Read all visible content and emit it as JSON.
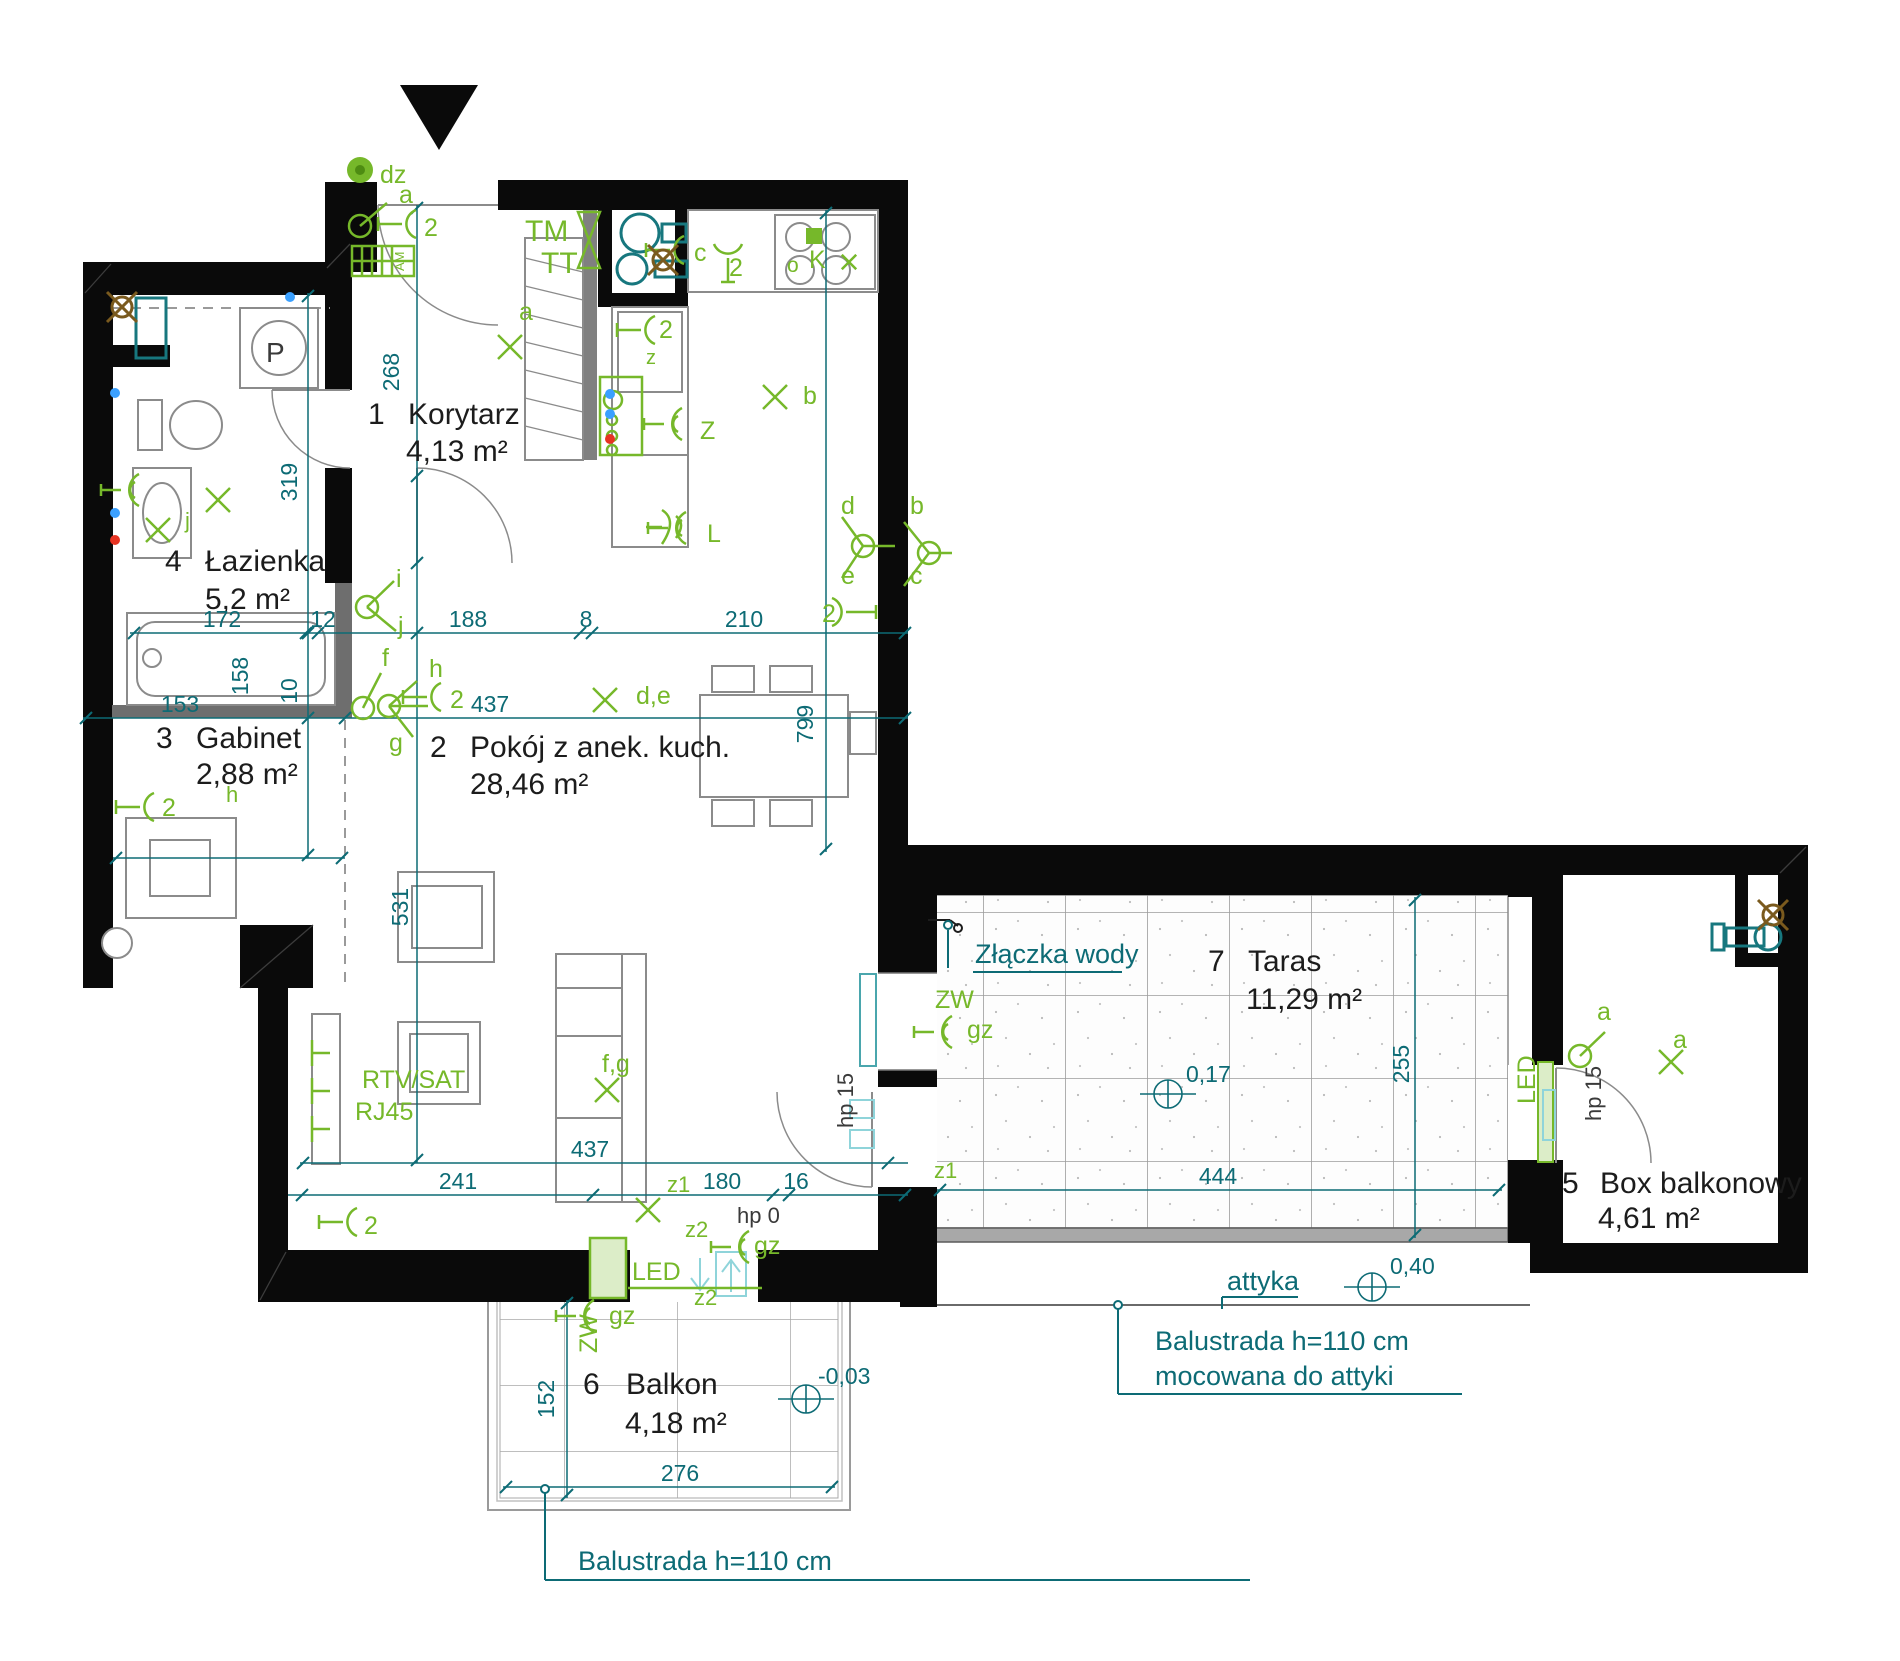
{
  "plan": {
    "width": 1900,
    "height": 1661,
    "background": "#ffffff"
  },
  "colors": {
    "wall": "#0a0a0a",
    "interior_wall": "#6e6e6e",
    "furniture": "#8b8b8b",
    "dim": "#0d6b75",
    "light_cyan": "#8fd4da",
    "el": "#76b82a",
    "fixture": "#17777e",
    "brown": "#7a5a1e",
    "text": "#1c1c1c",
    "gray_label": "#3a3a3a",
    "dot_blue": "#3aa0ff",
    "dot_red": "#e63322",
    "led_fill": "#dcedc8"
  },
  "rooms": [
    {
      "number": "1",
      "name": "Korytarz",
      "area": "4,13 m²",
      "nx": 368,
      "ny": 424,
      "tx": 408,
      "ty": 424,
      "ax": 406,
      "ay": 461
    },
    {
      "number": "2",
      "name": "Pokój z anek. kuch.",
      "area": "28,46 m²",
      "nx": 430,
      "ny": 757,
      "tx": 470,
      "ty": 757,
      "ax": 470,
      "ay": 794
    },
    {
      "number": "3",
      "name": "Gabinet",
      "area": "2,88 m²",
      "nx": 156,
      "ny": 748,
      "tx": 196,
      "ty": 748,
      "ax": 196,
      "ay": 784
    },
    {
      "number": "4",
      "name": "Łazienka",
      "area": "5,2 m²",
      "nx": 165,
      "ny": 571,
      "tx": 205,
      "ty": 571,
      "ax": 205,
      "ay": 609
    },
    {
      "number": "5",
      "name": "Box balkonowy",
      "area": "4,61 m²",
      "nx": 1562,
      "ny": 1193,
      "tx": 1600,
      "ty": 1193,
      "ax": 1598,
      "ay": 1228
    },
    {
      "number": "6",
      "name": "Balkon",
      "area": "4,18 m²",
      "nx": 583,
      "ny": 1394,
      "tx": 626,
      "ty": 1394,
      "ax": 625,
      "ay": 1433
    },
    {
      "number": "7",
      "name": "Taras",
      "area": "11,29 m²",
      "nx": 1208,
      "ny": 971,
      "tx": 1248,
      "ty": 971,
      "ax": 1246,
      "ay": 1009
    }
  ],
  "dimensions": [
    {
      "t": "172",
      "x": 222,
      "y": 627
    },
    {
      "t": "12",
      "x": 323,
      "y": 627
    },
    {
      "t": "188",
      "x": 468,
      "y": 627
    },
    {
      "t": "8",
      "x": 586,
      "y": 627
    },
    {
      "t": "210",
      "x": 744,
      "y": 627
    },
    {
      "t": "153",
      "x": 180,
      "y": 712
    },
    {
      "t": "437",
      "x": 490,
      "y": 712
    },
    {
      "t": "437",
      "x": 590,
      "y": 1157
    },
    {
      "t": "241",
      "x": 458,
      "y": 1189
    },
    {
      "t": "180",
      "x": 722,
      "y": 1189
    },
    {
      "t": "16",
      "x": 796,
      "y": 1189
    },
    {
      "t": "444",
      "x": 1218,
      "y": 1184
    },
    {
      "t": "276",
      "x": 680,
      "y": 1481
    },
    {
      "t": "268",
      "x": 399,
      "y": 372,
      "r": -90
    },
    {
      "t": "319",
      "x": 297,
      "y": 482,
      "r": -90
    },
    {
      "t": "158",
      "x": 248,
      "y": 676,
      "r": -90
    },
    {
      "t": "10",
      "x": 297,
      "y": 691,
      "r": -90
    },
    {
      "t": "531",
      "x": 408,
      "y": 907,
      "r": -90
    },
    {
      "t": "799",
      "x": 813,
      "y": 724,
      "r": -90
    },
    {
      "t": "255",
      "x": 1409,
      "y": 1064,
      "r": -90
    },
    {
      "t": "152",
      "x": 554,
      "y": 1399,
      "r": -90
    }
  ],
  "notes": [
    {
      "t": "Złączka wody",
      "x": 975,
      "y": 963
    },
    {
      "t": "attyka",
      "x": 1227,
      "y": 1290
    },
    {
      "t": "Balustrada h=110 cm",
      "x": 578,
      "y": 1570
    },
    {
      "t": "Balustrada h=110 cm",
      "x": 1155,
      "y": 1350
    },
    {
      "t": "mocowana do attyki",
      "x": 1155,
      "y": 1385
    }
  ],
  "elevations": [
    {
      "t": "0,17",
      "x": 1186,
      "y": 1082,
      "cx": 1168,
      "cy": 1094
    },
    {
      "t": "0,40",
      "x": 1390,
      "y": 1274,
      "cx": 1372,
      "cy": 1287
    },
    {
      "t": "-0,03",
      "x": 818,
      "y": 1384,
      "cx": 806,
      "cy": 1399
    }
  ],
  "gray_labels": [
    {
      "t": "hp 0",
      "x": 737,
      "y": 1223
    },
    {
      "t": "hp 15",
      "x": 853,
      "y": 1128,
      "r": -90
    },
    {
      "t": "hp 15",
      "x": 1601,
      "y": 1121,
      "r": -90
    },
    {
      "t": "P",
      "x": 266,
      "y": 362,
      "s": 28
    }
  ],
  "green_labels": [
    {
      "t": "dz",
      "x": 380,
      "y": 183
    },
    {
      "t": "a",
      "x": 399,
      "y": 203
    },
    {
      "t": "2",
      "x": 424,
      "y": 236
    },
    {
      "t": "a",
      "x": 519,
      "y": 320
    },
    {
      "t": "TM",
      "x": 525,
      "y": 241,
      "s": 30
    },
    {
      "t": "TT",
      "x": 541,
      "y": 273,
      "s": 30
    },
    {
      "t": "c",
      "x": 694,
      "y": 261
    },
    {
      "t": "2",
      "x": 729,
      "y": 276
    },
    {
      "t": "o",
      "x": 787,
      "y": 272,
      "s": 21
    },
    {
      "t": "K",
      "x": 809,
      "y": 268
    },
    {
      "t": "2",
      "x": 659,
      "y": 338
    },
    {
      "t": "z",
      "x": 646,
      "y": 364,
      "s": 20
    },
    {
      "t": "Z",
      "x": 700,
      "y": 439
    },
    {
      "t": "L",
      "x": 707,
      "y": 542
    },
    {
      "t": "b",
      "x": 803,
      "y": 404
    },
    {
      "t": "d",
      "x": 841,
      "y": 514
    },
    {
      "t": "b",
      "x": 910,
      "y": 514
    },
    {
      "t": "e",
      "x": 841,
      "y": 584
    },
    {
      "t": "c",
      "x": 910,
      "y": 584
    },
    {
      "t": "2",
      "x": 822,
      "y": 622
    },
    {
      "t": "d,e",
      "x": 636,
      "y": 704
    },
    {
      "t": "i",
      "x": 396,
      "y": 587
    },
    {
      "t": "j",
      "x": 398,
      "y": 634
    },
    {
      "t": "f",
      "x": 382,
      "y": 666
    },
    {
      "t": "h",
      "x": 429,
      "y": 677
    },
    {
      "t": "2",
      "x": 450,
      "y": 708
    },
    {
      "t": "g",
      "x": 389,
      "y": 751
    },
    {
      "t": "j",
      "x": 185,
      "y": 528,
      "s": 22
    },
    {
      "t": "h",
      "x": 226,
      "y": 802,
      "s": 22
    },
    {
      "t": "2",
      "x": 162,
      "y": 816
    },
    {
      "t": "RTV/SAT",
      "x": 362,
      "y": 1088
    },
    {
      "t": "RJ45",
      "x": 355,
      "y": 1120
    },
    {
      "t": "2",
      "x": 364,
      "y": 1234
    },
    {
      "t": "f,g",
      "x": 602,
      "y": 1072
    },
    {
      "t": "z1",
      "x": 667,
      "y": 1192,
      "s": 22
    },
    {
      "t": "z2",
      "x": 685,
      "y": 1237,
      "s": 22
    },
    {
      "t": "z2",
      "x": 694,
      "y": 1305,
      "s": 22
    },
    {
      "t": "gz",
      "x": 754,
      "y": 1254
    },
    {
      "t": "LED",
      "x": 632,
      "y": 1280
    },
    {
      "t": "gz",
      "x": 609,
      "y": 1324
    },
    {
      "t": "ZW",
      "x": 597,
      "y": 1353,
      "r": -90
    },
    {
      "t": "ZW",
      "x": 935,
      "y": 1008
    },
    {
      "t": "gz",
      "x": 967,
      "y": 1038
    },
    {
      "t": "z1",
      "x": 934,
      "y": 1178,
      "s": 22
    },
    {
      "t": "LED",
      "x": 1535,
      "y": 1104,
      "r": -90
    },
    {
      "t": "a",
      "x": 1597,
      "y": 1020
    },
    {
      "t": "a",
      "x": 1673,
      "y": 1048
    },
    {
      "t": "AM",
      "x": 404,
      "y": 271,
      "s": 13,
      "r": -90
    }
  ],
  "lines": [
    {
      "x1": 130,
      "y1": 633,
      "x2": 908,
      "y2": 633
    },
    {
      "x1": 83,
      "y1": 718,
      "x2": 908,
      "y2": 718
    },
    {
      "x1": 113,
      "y1": 858,
      "x2": 345,
      "y2": 858
    },
    {
      "x1": 300,
      "y1": 1163,
      "x2": 908,
      "y2": 1163
    },
    {
      "x1": 288,
      "y1": 1195,
      "x2": 908,
      "y2": 1195
    },
    {
      "x1": 937,
      "y1": 1190,
      "x2": 1502,
      "y2": 1190
    },
    {
      "x1": 503,
      "y1": 1487,
      "x2": 835,
      "y2": 1487
    },
    {
      "x1": 417,
      "y1": 205,
      "x2": 417,
      "y2": 1163
    },
    {
      "x1": 308,
      "y1": 293,
      "x2": 308,
      "y2": 858
    },
    {
      "x1": 826,
      "y1": 210,
      "x2": 826,
      "y2": 852
    },
    {
      "x1": 1415,
      "y1": 897,
      "x2": 1415,
      "y2": 1238
    },
    {
      "x1": 567,
      "y1": 1300,
      "x2": 567,
      "y2": 1498
    },
    {
      "x1": 973,
      "y1": 972,
      "x2": 1122,
      "y2": 972,
      "w": 2
    },
    {
      "x1": 948,
      "y1": 930,
      "x2": 948,
      "y2": 968,
      "w": 2
    },
    {
      "x1": 1222,
      "y1": 1297,
      "x2": 1298,
      "y2": 1297,
      "w": 2
    },
    {
      "x1": 1222,
      "y1": 1297,
      "x2": 1222,
      "y2": 1309,
      "w": 2
    },
    {
      "x1": 545,
      "y1": 1492,
      "x2": 545,
      "y2": 1580,
      "w": 2
    },
    {
      "x1": 545,
      "y1": 1580,
      "x2": 1250,
      "y2": 1580,
      "w": 2
    },
    {
      "x1": 1118,
      "y1": 1308,
      "x2": 1118,
      "y2": 1394,
      "w": 2
    },
    {
      "x1": 1118,
      "y1": 1394,
      "x2": 1462,
      "y2": 1394,
      "w": 2
    },
    {
      "x1": 628,
      "y1": 1288,
      "x2": 762,
      "y2": 1288,
      "c": "el",
      "w": 2.5
    }
  ],
  "ticks": [
    [
      134,
      633
    ],
    [
      306,
      633
    ],
    [
      318,
      633
    ],
    [
      580,
      633
    ],
    [
      592,
      633
    ],
    [
      905,
      633
    ],
    [
      86,
      718
    ],
    [
      345,
      718
    ],
    [
      905,
      718
    ],
    [
      116,
      858
    ],
    [
      342,
      858
    ],
    [
      303,
      1163
    ],
    [
      888,
      1163
    ],
    [
      302,
      1195
    ],
    [
      593,
      1195
    ],
    [
      773,
      1195
    ],
    [
      789,
      1195
    ],
    [
      905,
      1195
    ],
    [
      940,
      1190
    ],
    [
      1499,
      1190
    ],
    [
      506,
      1487
    ],
    [
      832,
      1487
    ],
    [
      417,
      208
    ],
    [
      417,
      476
    ],
    [
      417,
      563
    ],
    [
      417,
      633
    ],
    [
      417,
      1160
    ],
    [
      308,
      296
    ],
    [
      308,
      633
    ],
    [
      308,
      718
    ],
    [
      308,
      855
    ],
    [
      826,
      213
    ],
    [
      826,
      849
    ],
    [
      1415,
      900
    ],
    [
      1415,
      1235
    ],
    [
      567,
      1303
    ],
    [
      567,
      1495
    ]
  ],
  "symbols": [
    {
      "k": "x",
      "x": 510,
      "y": 347
    },
    {
      "k": "x",
      "x": 775,
      "y": 397
    },
    {
      "k": "x",
      "x": 605,
      "y": 700
    },
    {
      "k": "x",
      "x": 218,
      "y": 500
    },
    {
      "k": "x",
      "x": 158,
      "y": 530
    },
    {
      "k": "x",
      "x": 607,
      "y": 1090
    },
    {
      "k": "x",
      "x": 648,
      "y": 1210
    },
    {
      "k": "x",
      "x": 1671,
      "y": 1062
    },
    {
      "k": "x",
      "x": 849,
      "y": 262,
      "s": 0.6
    },
    {
      "k": "sock",
      "x": 408,
      "y": 224
    },
    {
      "k": "sock",
      "x": 647,
      "y": 330
    },
    {
      "k": "sock",
      "x": 433,
      "y": 697
    },
    {
      "k": "sock",
      "x": 146,
      "y": 807
    },
    {
      "k": "sock",
      "x": 349,
      "y": 1222
    },
    {
      "k": "sock",
      "x": 840,
      "y": 612,
      "m": 1
    },
    {
      "k": "sock",
      "x": 676,
      "y": 250
    },
    {
      "k": "sock",
      "x": 728,
      "y": 252,
      "r": -90
    },
    {
      "k": "tap",
      "x": 125,
      "y": 490
    },
    {
      "k": "tap",
      "x": 938,
      "y": 1032
    },
    {
      "k": "tap",
      "x": 580,
      "y": 1316
    },
    {
      "k": "tap",
      "x": 668,
      "y": 424
    },
    {
      "k": "tap",
      "x": 672,
      "y": 528
    },
    {
      "k": "tap",
      "x": 735,
      "y": 1247
    },
    {
      "k": "sw",
      "x": 360,
      "y": 226,
      "st": [
        [
          387,
          203
        ]
      ]
    },
    {
      "k": "sw",
      "x": 367,
      "y": 607,
      "st": [
        [
          394,
          581
        ],
        [
          396,
          631
        ]
      ]
    },
    {
      "k": "sw",
      "x": 363,
      "y": 708,
      "st": [
        [
          381,
          673
        ]
      ]
    },
    {
      "k": "sw",
      "x": 389,
      "y": 706,
      "st": [
        [
          417,
          681
        ],
        [
          413,
          737
        ],
        [
          428,
          706
        ]
      ]
    },
    {
      "k": "sw",
      "x": 863,
      "y": 546,
      "st": [
        [
          842,
          517
        ],
        [
          842,
          578
        ],
        [
          895,
          546
        ]
      ]
    },
    {
      "k": "sw",
      "x": 929,
      "y": 553,
      "st": [
        [
          904,
          522
        ],
        [
          904,
          586
        ],
        [
          952,
          553
        ]
      ]
    },
    {
      "k": "sw",
      "x": 1580,
      "y": 1056,
      "st": [
        [
          1605,
          1032
        ]
      ]
    },
    {
      "k": "drain",
      "x": 122,
      "y": 307
    },
    {
      "k": "drain",
      "x": 663,
      "y": 260
    },
    {
      "k": "drain",
      "x": 1773,
      "y": 915
    },
    {
      "k": "dot",
      "x": 115,
      "y": 393,
      "c": "dot_blue"
    },
    {
      "k": "dot",
      "x": 115,
      "y": 513,
      "c": "dot_blue"
    },
    {
      "k": "dot",
      "x": 290,
      "y": 297,
      "c": "dot_blue"
    },
    {
      "k": "dot",
      "x": 610,
      "y": 394,
      "c": "dot_blue"
    },
    {
      "k": "dot",
      "x": 610,
      "y": 414,
      "c": "dot_blue"
    },
    {
      "k": "dot",
      "x": 115,
      "y": 540,
      "c": "dot_red"
    },
    {
      "k": "dot",
      "x": 610,
      "y": 439,
      "c": "dot_red"
    },
    {
      "k": "ring",
      "x": 545,
      "y": 1489
    },
    {
      "k": "ring",
      "x": 1118,
      "y": 1305
    },
    {
      "k": "ring",
      "x": 948,
      "y": 925
    }
  ]
}
